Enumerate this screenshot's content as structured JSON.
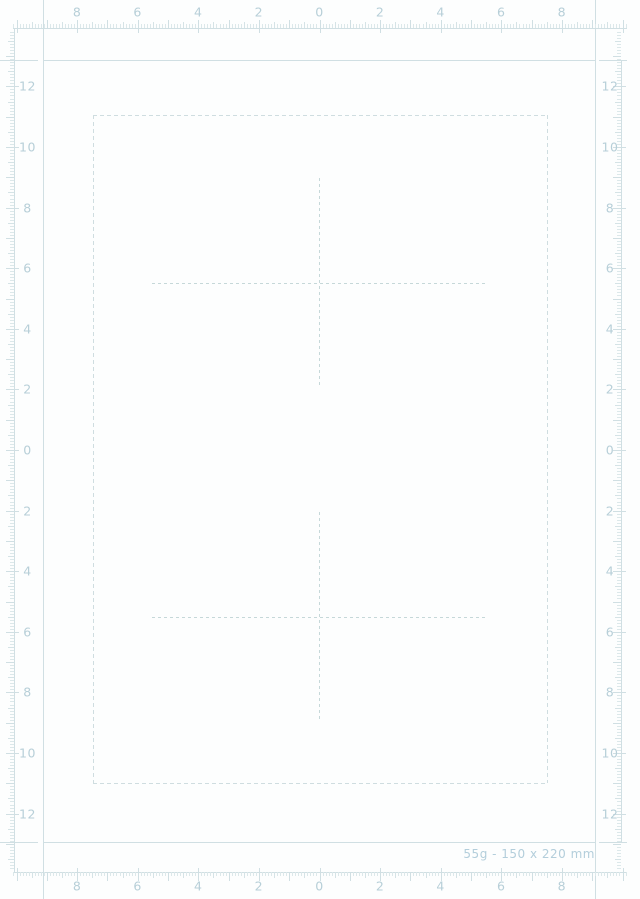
{
  "caption": "55g - 150 x 220 mm",
  "paper_spec": {
    "weight": "55g",
    "size": "150 x 220 mm"
  },
  "rulers": {
    "top_labels": [
      "8",
      "6",
      "4",
      "2",
      "0",
      "2",
      "4",
      "6",
      "8"
    ],
    "bottom_labels": [
      "8",
      "6",
      "4",
      "2",
      "0",
      "2",
      "4",
      "6",
      "8"
    ],
    "left_labels": [
      "12",
      "10",
      "8",
      "6",
      "4",
      "2",
      "0",
      "2",
      "4",
      "6",
      "8",
      "10",
      "12"
    ],
    "right_labels": [
      "12",
      "10",
      "8",
      "6",
      "4",
      "2",
      "0",
      "2",
      "4",
      "6",
      "8",
      "10",
      "12"
    ]
  },
  "colors": {
    "background": "#fdfefe",
    "line": "#d0dfe3",
    "tick_minor": "#dce8ea",
    "tick_mid": "#d5e3e6",
    "tick_major": "#d0dfe3",
    "label_text": "#b7cfd8",
    "caption_text": "#b3cedb",
    "paper_outline_dash": "#cfdde0",
    "cross_dash": "#c6d8d9"
  }
}
